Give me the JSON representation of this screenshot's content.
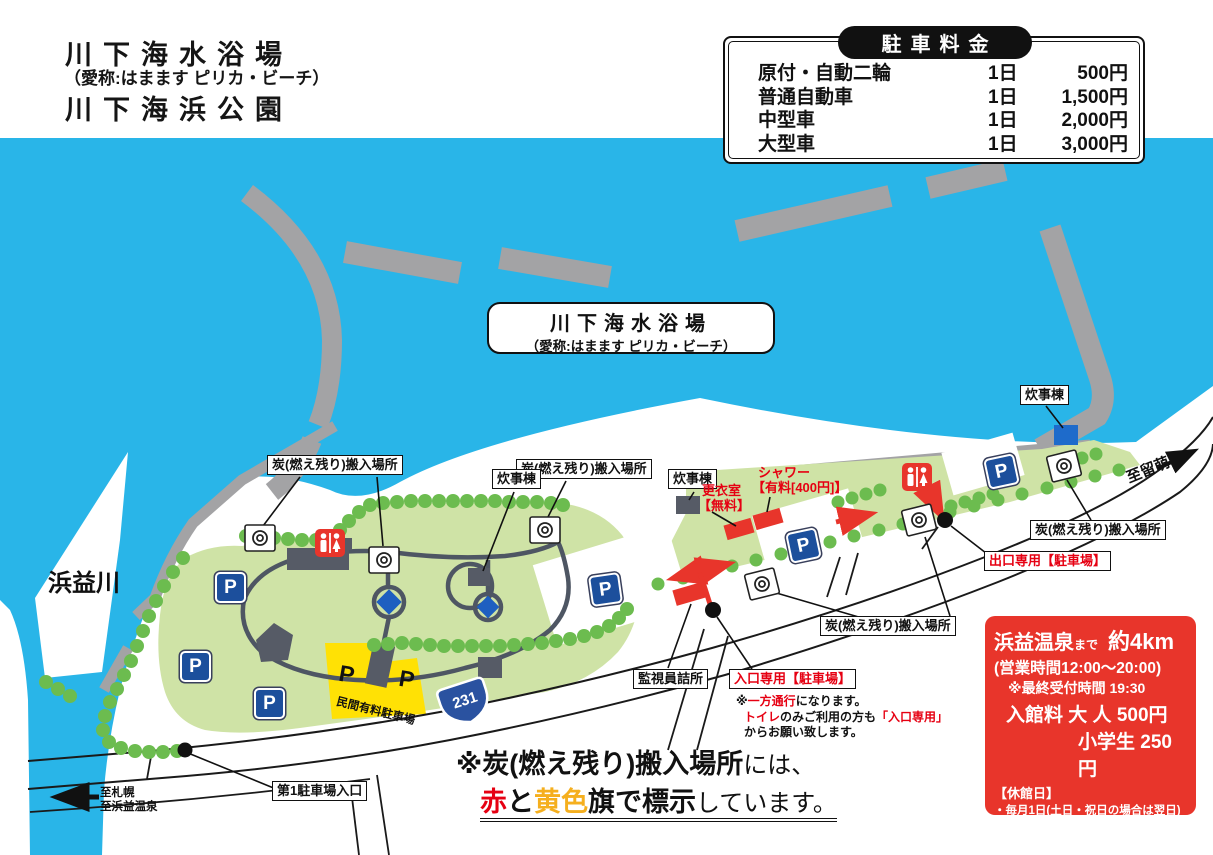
{
  "title": {
    "line1": "川下海水浴場",
    "line2": "（愛称:はまます ピリカ・ビーチ）",
    "line3": "川下海浜公園"
  },
  "parking_table": {
    "header": "駐車料金",
    "rows": [
      {
        "vehicle": "原付・自動二輪",
        "unit": "1日",
        "price": "500円"
      },
      {
        "vehicle": "普通自動車",
        "unit": "1日",
        "price": "1,500円"
      },
      {
        "vehicle": "中型車",
        "unit": "1日",
        "price": "2,000円"
      },
      {
        "vehicle": "大型車",
        "unit": "1日",
        "price": "3,000円"
      }
    ]
  },
  "beach_label": {
    "line1": "川下海水浴場",
    "line2": "（愛称:はまます ピリカ・ビーチ）"
  },
  "map_labels": {
    "river": "浜益川",
    "charcoal": "炭(燃え残り)搬入場所",
    "cooking": "炊事棟",
    "guard": "監視員詰所",
    "entrance": "入口専用【駐車場】",
    "exit": "出口専用【駐車場】",
    "parking_lot1": "第1駐車場入口",
    "private_parking": "民間有料駐車場",
    "route_number": "231",
    "to_rumoi": "至留萌",
    "to_sapporo": "至札幌",
    "to_onsen": "至浜益温泉",
    "parking_p": "P",
    "shower_line1": "シャワー",
    "shower_line2": "【有料[400円]】",
    "changing_line1": "更衣室",
    "changing_line2": "【無料】"
  },
  "entrance_note": {
    "l1a": "※",
    "l1b": "一方通行",
    "l1c": "になります。",
    "l2a": "トイレ",
    "l2b": "のみご利用の方も",
    "l2c": "「入口専用」",
    "l3": "からお願い致します。"
  },
  "notice": {
    "bold": "※炭(燃え残り)搬入場所",
    "tail": "には、",
    "red": "赤",
    "mid": "と",
    "yellow": "黄色",
    "bold2": "旗で標示",
    "tail2": "しています。"
  },
  "onsen_box": {
    "name": "浜益温泉",
    "made": "まで",
    "distance": "約4km",
    "hours": "(営業時間12:00～20:00)",
    "last_entry": "※最終受付時間 19:30",
    "fee_adult": "入館料 大 人 500円",
    "fee_child": "小学生 250円",
    "closed_header": "【休館日】",
    "closed_1": "・毎月1日(土日・祝日の場合は翌日)",
    "closed_1_note": "※5月・8月は除く",
    "closed_2": "・毎週火曜日",
    "direction": "ENEOS・GS信号左折"
  },
  "colors": {
    "water": "#29B5E8",
    "park_green": "#CFE3A6",
    "tree_green": "#6CBC4F",
    "marker_red": "#E8352B",
    "text_red": "#E60012",
    "flag_yellow": "#F5AF1E",
    "parking_yellow": "#FFE105",
    "parking_blue": "#1C4F9C",
    "route_blue": "#2A52A0",
    "breakwater_gray": "#A3A3A5"
  }
}
